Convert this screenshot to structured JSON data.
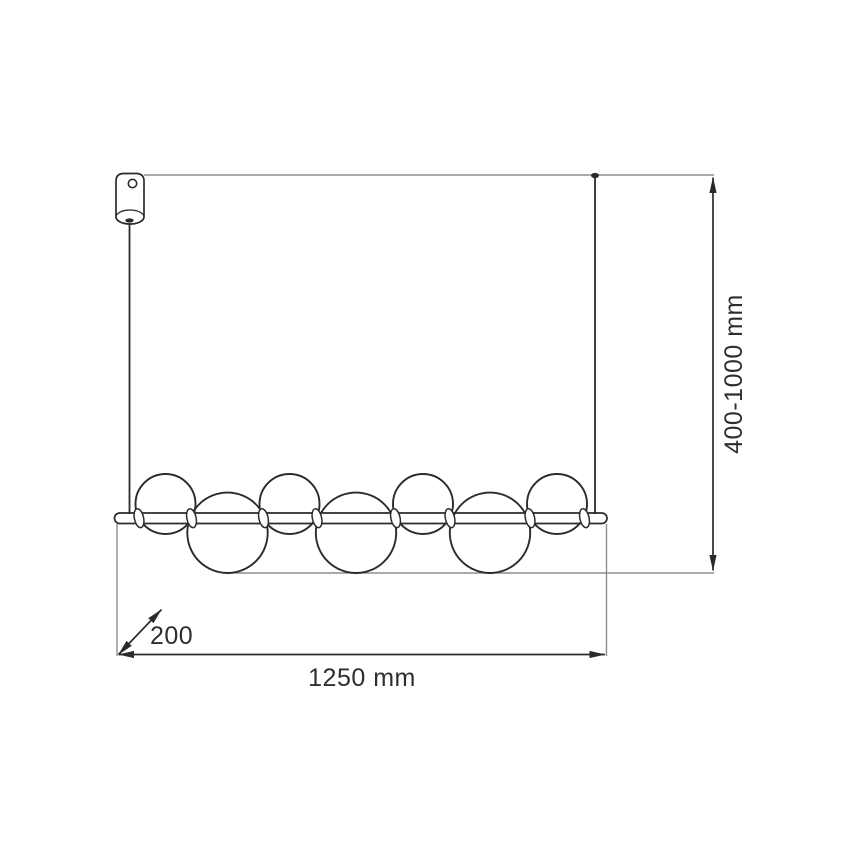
{
  "colors": {
    "background": "#ffffff",
    "ink": "#2b2b2b",
    "construction": "#8d8d8d",
    "text": "#2e2e2e"
  },
  "dimensions": {
    "suspension_height": {
      "label": "400-1000 mm"
    },
    "width": {
      "label": "1250 mm"
    },
    "depth": {
      "label": "200"
    }
  },
  "fixture": {
    "sphere_count": 7,
    "connector_ring_count": 8
  }
}
